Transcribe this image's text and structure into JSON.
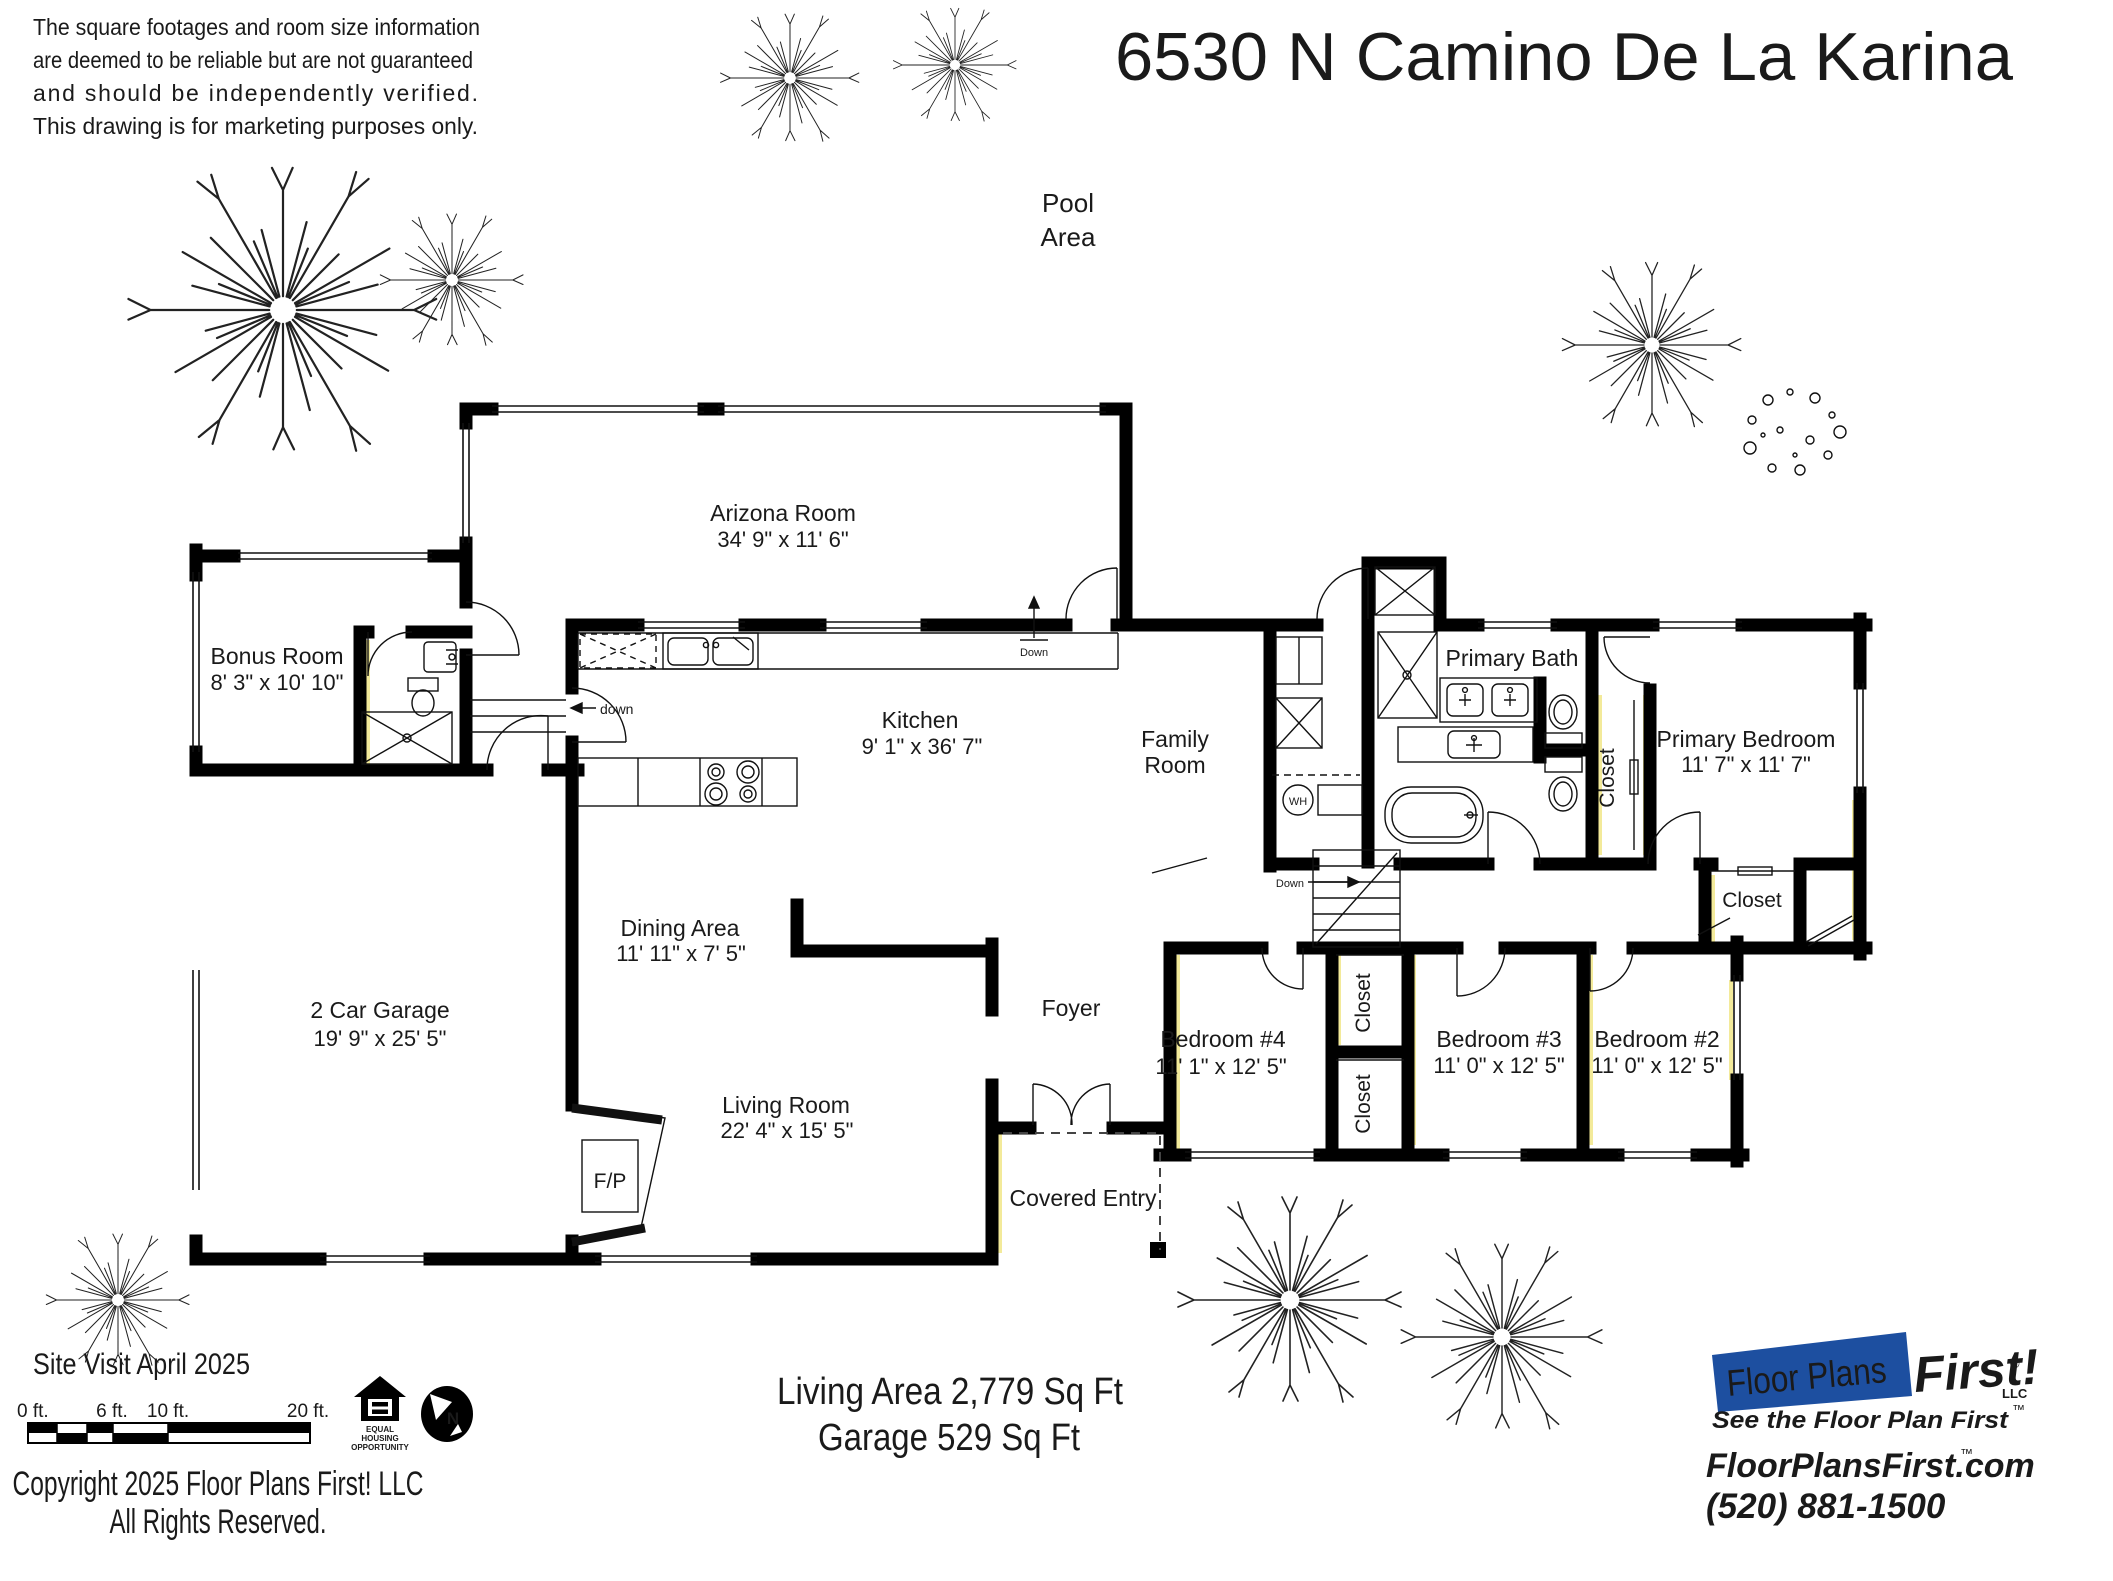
{
  "disclaimer": {
    "line1": "The square footages and room size information",
    "line2": "are deemed to be reliable but are not guaranteed",
    "line3": "and should be independently verified.",
    "line4": "This drawing is for marketing purposes only."
  },
  "title": "6530 N Camino De La Karina",
  "pool_area": {
    "line1": "Pool",
    "line2": "Area"
  },
  "rooms": {
    "arizona": {
      "name": "Arizona Room",
      "dims": "34' 9\" x 11' 6\""
    },
    "bonus": {
      "name": "Bonus Room",
      "dims": "8' 3\" x 10' 10\""
    },
    "kitchen": {
      "name": "Kitchen",
      "dims": "9' 1\" x 36' 7\""
    },
    "family": {
      "line1": "Family",
      "line2": "Room"
    },
    "primary_bath": {
      "name": "Primary Bath"
    },
    "primary_bedroom": {
      "name": "Primary Bedroom",
      "dims": "11' 7\" x 11' 7\""
    },
    "bedroom4": {
      "name": "Bedroom #4",
      "dims": "11' 1\" x 12' 5\""
    },
    "bedroom3": {
      "name": "Bedroom #3",
      "dims": "11' 0\" x 12' 5\""
    },
    "bedroom2": {
      "name": "Bedroom #2",
      "dims": "11' 0\" x 12' 5\""
    },
    "dining": {
      "name": "Dining Area",
      "dims": "11' 11\" x 7' 5\""
    },
    "living": {
      "name": "Living Room",
      "dims": "22' 4\" x 15' 5\""
    },
    "garage": {
      "name": "2 Car Garage",
      "dims": "19' 9\" x 25' 5\""
    },
    "foyer": {
      "name": "Foyer"
    },
    "cov_entry": {
      "name": "Covered Entry"
    }
  },
  "labels": {
    "closet": "Closet",
    "fireplace": "F/P",
    "water_heater": "WH",
    "down_kitchen": "down",
    "down_arizona": "Down",
    "down_stairs": "Down"
  },
  "footer": {
    "site_visit": "Site Visit April 2025",
    "scale_ticks": [
      "0 ft.",
      "6 ft.",
      "10 ft.",
      "20 ft."
    ],
    "copyright_line1": "Copyright 2025 Floor Plans First! LLC",
    "copyright_line2": "All Rights Reserved.",
    "living_area": "Living Area 2,779 Sq Ft",
    "garage_area": "Garage 529 Sq Ft"
  },
  "equal_housing": {
    "line1": "EQUAL",
    "line2": "HOUSING",
    "line3": "OPPORTUNITY"
  },
  "north": {
    "letter": "N"
  },
  "icons": {
    "tree": "plan-tree-symbol",
    "north_arrow": "compass-north",
    "equal_housing": "equal-housing-house"
  },
  "logo": {
    "name_left": "Floor Plans",
    "name_right": "First!",
    "reg": "®",
    "llc": "LLC",
    "tagline": "See the Floor Plan First",
    "tm": "™",
    "website": "FloorPlansFirst.com",
    "website_tm": "™",
    "phone": "(520) 881-1500",
    "blue": "#1d4fa0",
    "red": "#da2a1f"
  }
}
